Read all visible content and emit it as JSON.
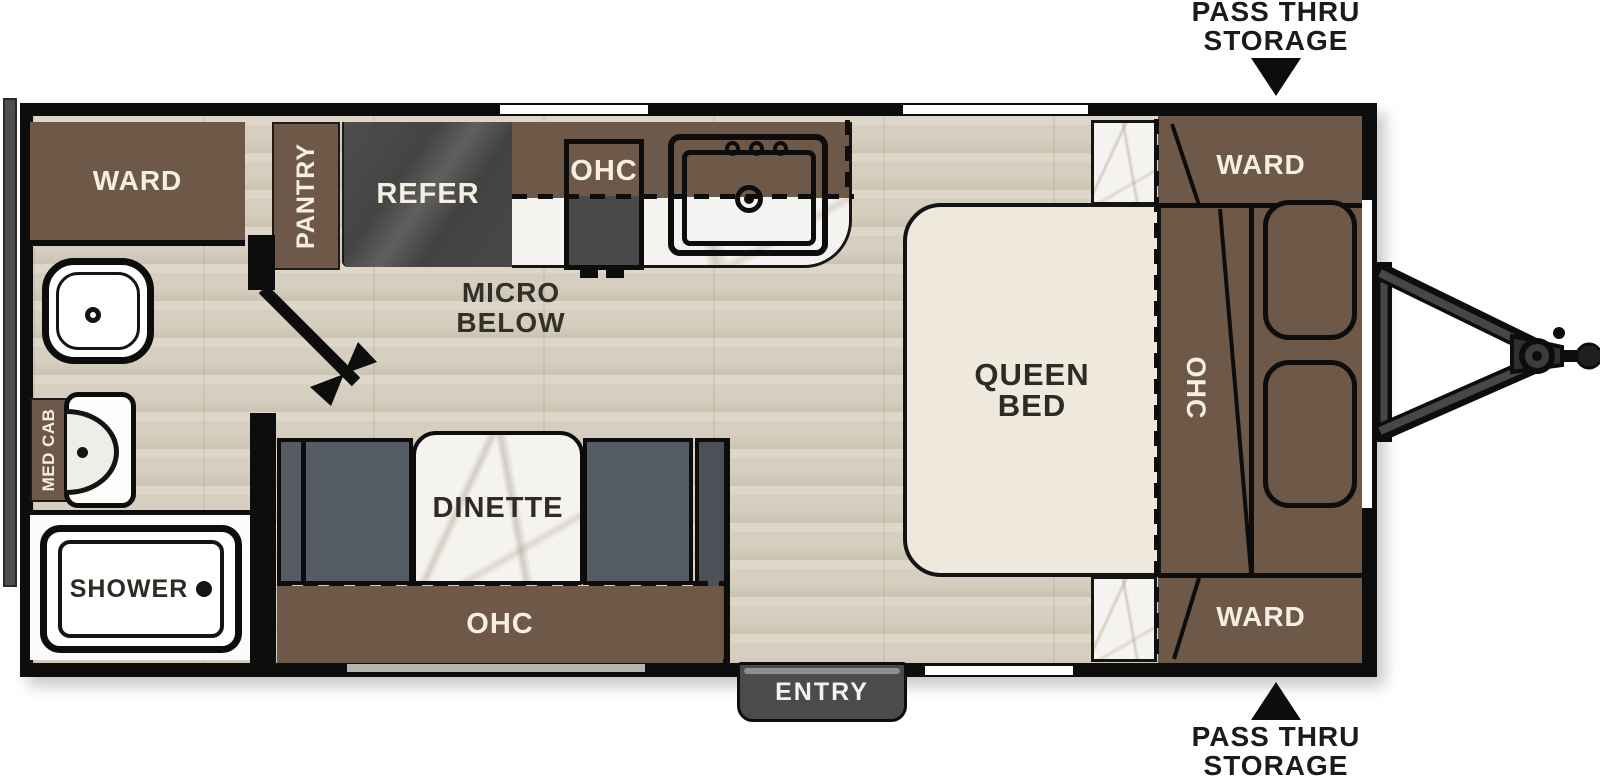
{
  "colors": {
    "wall": "#0d0d0d",
    "cabinet_brown": "#6e5948",
    "bench_gray": "#565c66",
    "refer_gray": "#4a4a4a",
    "floor_wood": "#d8d1c2",
    "bed_cream": "#efe9dd",
    "marble": "#f5f3ef",
    "entry_gray": "#4b4b4b",
    "label_light": "#f5efe3",
    "label_dark": "#2e2a24"
  },
  "floorplan": {
    "bathroom": {
      "ward_label": "WARD",
      "med_cab_label": "MED CAB",
      "shower_label": "SHOWER"
    },
    "kitchen": {
      "pantry_label": "PANTRY",
      "refer_label": "REFER",
      "ohc_label": "OHC",
      "micro_label_line1": "MICRO",
      "micro_label_line2": "BELOW"
    },
    "dinette": {
      "table_label": "DINETTE",
      "ohc_label": "OHC"
    },
    "bedroom": {
      "bed_label_line1": "QUEEN",
      "bed_label_line2": "BED",
      "ohc_label": "OHC",
      "ward_top_label": "WARD",
      "ward_bottom_label": "WARD"
    },
    "entry_label": "ENTRY",
    "pass_thru_top": {
      "line1": "PASS THRU",
      "line2": "STORAGE"
    },
    "pass_thru_bottom": {
      "line1": "PASS THRU",
      "line2": "STORAGE"
    }
  }
}
